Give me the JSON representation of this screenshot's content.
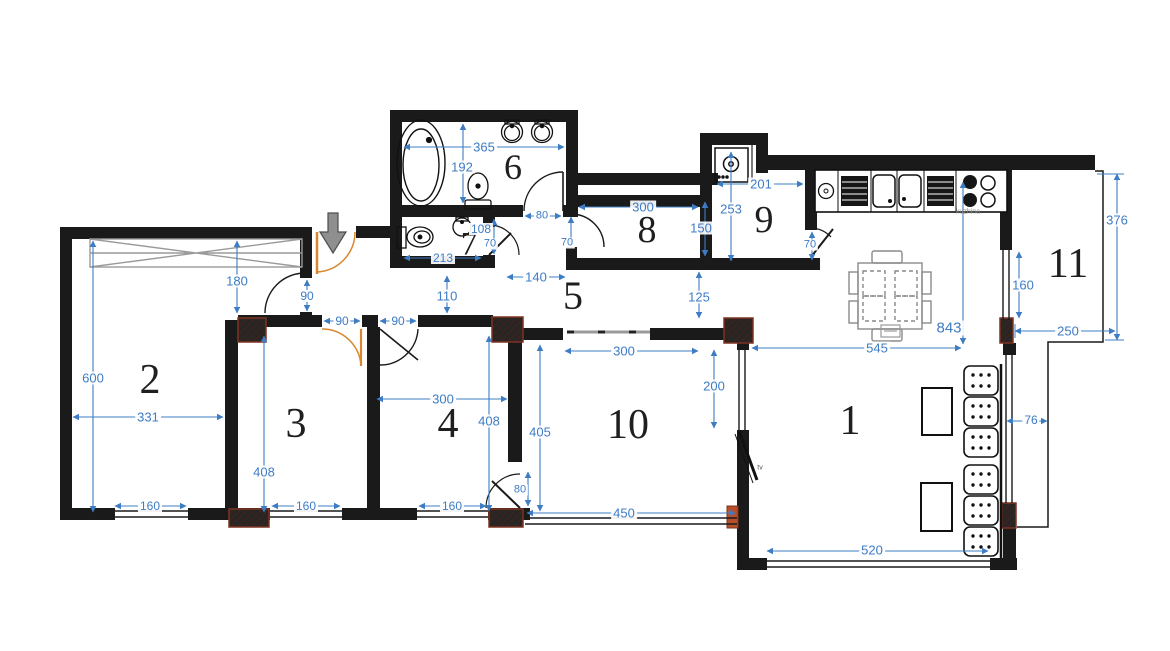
{
  "title": "Apartment floor plan",
  "colors": {
    "wall": "#1a1a1a",
    "dimension_blue": "#3e7cc4",
    "door_orange": "#d9872e",
    "column_edge": "#7e3322",
    "furniture_gray": "#9a9a9a",
    "arrow_gray": "#8f8f8f"
  },
  "rooms": [
    {
      "label": "1",
      "x": 850,
      "y": 421,
      "size": 42
    },
    {
      "label": "2",
      "x": 150,
      "y": 380,
      "size": 42
    },
    {
      "label": "3",
      "x": 296,
      "y": 424,
      "size": 42
    },
    {
      "label": "4",
      "x": 448,
      "y": 424,
      "size": 42
    },
    {
      "label": "5",
      "x": 573,
      "y": 296,
      "size": 40
    },
    {
      "label": "6",
      "x": 513,
      "y": 167,
      "size": 36
    },
    {
      "label": "7",
      "x": 469,
      "y": 245,
      "size": 33
    },
    {
      "label": "8",
      "x": 647,
      "y": 230,
      "size": 38
    },
    {
      "label": "9",
      "x": 764,
      "y": 220,
      "size": 38
    },
    {
      "label": "10",
      "x": 628,
      "y": 425,
      "size": 42
    },
    {
      "label": "11",
      "x": 1068,
      "y": 264,
      "size": 42
    }
  ],
  "dimensions": [
    {
      "text": "180",
      "x": 237,
      "y": 281
    },
    {
      "text": "90",
      "x": 307,
      "y": 296,
      "size": 12
    },
    {
      "text": "90",
      "x": 342,
      "y": 321,
      "size": 12
    },
    {
      "text": "90",
      "x": 398,
      "y": 321,
      "size": 12
    },
    {
      "text": "110",
      "x": 447,
      "y": 296
    },
    {
      "text": "140",
      "x": 536,
      "y": 277
    },
    {
      "text": "365",
      "x": 484,
      "y": 147
    },
    {
      "text": "192",
      "x": 462,
      "y": 167
    },
    {
      "text": "213",
      "x": 443,
      "y": 258,
      "size": 12
    },
    {
      "text": "108",
      "x": 481,
      "y": 229,
      "size": 12
    },
    {
      "text": "70",
      "x": 490,
      "y": 244,
      "size": 11
    },
    {
      "text": "80",
      "x": 542,
      "y": 216,
      "size": 11
    },
    {
      "text": "70",
      "x": 567,
      "y": 243,
      "size": 11
    },
    {
      "text": "300",
      "x": 643,
      "y": 207
    },
    {
      "text": "150",
      "x": 701,
      "y": 228
    },
    {
      "text": "125",
      "x": 699,
      "y": 297
    },
    {
      "text": "201",
      "x": 761,
      "y": 184
    },
    {
      "text": "253",
      "x": 731,
      "y": 209
    },
    {
      "text": "70",
      "x": 810,
      "y": 245,
      "size": 11
    },
    {
      "text": "843",
      "x": 949,
      "y": 328,
      "size": 15
    },
    {
      "text": "545",
      "x": 877,
      "y": 348
    },
    {
      "text": "160",
      "x": 1023,
      "y": 285
    },
    {
      "text": "376",
      "x": 1117,
      "y": 220
    },
    {
      "text": "250",
      "x": 1068,
      "y": 331
    },
    {
      "text": "600",
      "x": 93,
      "y": 378
    },
    {
      "text": "331",
      "x": 148,
      "y": 417
    },
    {
      "text": "160",
      "x": 150,
      "y": 506,
      "size": 12
    },
    {
      "text": "408",
      "x": 264,
      "y": 472
    },
    {
      "text": "160",
      "x": 306,
      "y": 506,
      "size": 12
    },
    {
      "text": "300",
      "x": 443,
      "y": 399
    },
    {
      "text": "408",
      "x": 489,
      "y": 421
    },
    {
      "text": "160",
      "x": 452,
      "y": 506,
      "size": 12
    },
    {
      "text": "405",
      "x": 540,
      "y": 432
    },
    {
      "text": "80",
      "x": 520,
      "y": 490,
      "size": 11
    },
    {
      "text": "300",
      "x": 624,
      "y": 351
    },
    {
      "text": "450",
      "x": 624,
      "y": 513
    },
    {
      "text": "200",
      "x": 714,
      "y": 386
    },
    {
      "text": "520",
      "x": 872,
      "y": 550
    },
    {
      "text": "76",
      "x": 1031,
      "y": 420,
      "size": 12
    }
  ],
  "annotations": [
    {
      "text": "kuzhina",
      "x": 968,
      "y": 212,
      "size": 7,
      "color": "#8a8a8a"
    },
    {
      "text": "tv",
      "x": 760,
      "y": 468,
      "size": 7,
      "color": "#555555"
    }
  ]
}
